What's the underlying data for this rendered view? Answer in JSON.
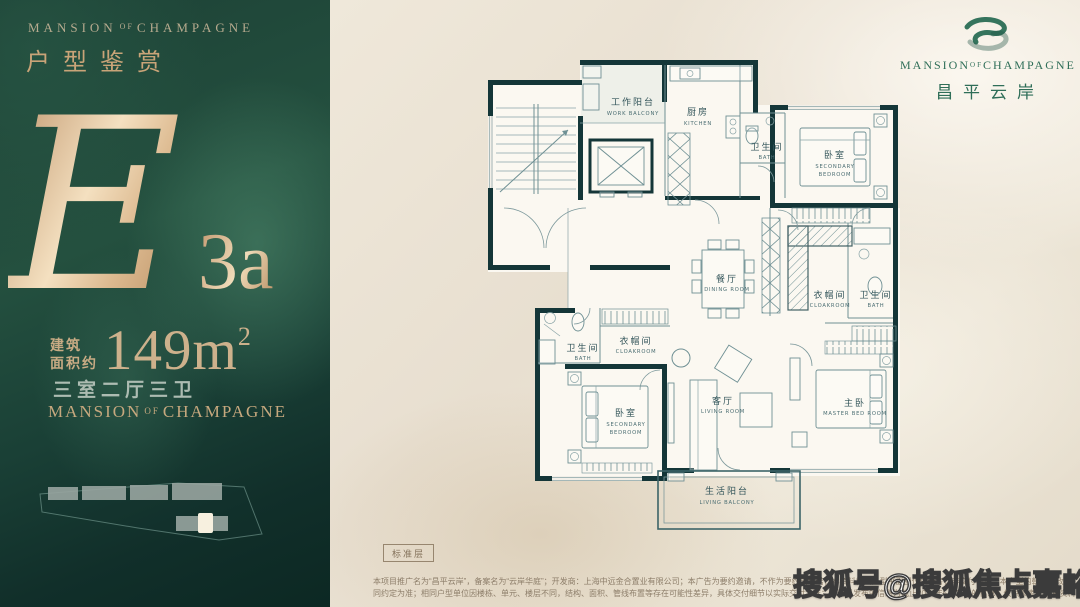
{
  "left_panel": {
    "brand_top": {
      "w1": "MANSION",
      "w2": "OF",
      "w3": "CHAMPAGNE"
    },
    "section_title": "户型鉴赏",
    "unit": {
      "letter": "E",
      "variant": "3a"
    },
    "area": {
      "prefix_line1": "建筑",
      "prefix_line2": "面积约",
      "value": "149m",
      "sup": "2"
    },
    "layout_desc": "三室二厅三卫",
    "brand_bottom": {
      "w1": "MANSION",
      "w2": "OF",
      "w3": "CHAMPAGNE"
    }
  },
  "logo": {
    "brand": {
      "w1": "MANSION",
      "w2": "OF",
      "w3": "CHAMPAGNE"
    },
    "cn": "昌平云岸"
  },
  "floorplan": {
    "floor_tag": "标准层",
    "rooms": {
      "work_balcony": {
        "zh": "工作阳台",
        "en": "WORK BALCONY"
      },
      "kitchen": {
        "zh": "厨房",
        "en": "KITCHEN"
      },
      "bath_top": {
        "zh": "卫生间",
        "en": "BATH"
      },
      "bedroom_top": {
        "zh": "卧室",
        "en1": "SECONDARY",
        "en2": "BEDROOM"
      },
      "dining": {
        "zh": "餐厅",
        "en": "DINING ROOM"
      },
      "cloakroom_right": {
        "zh": "衣帽间",
        "en": "CLOAKROOM"
      },
      "bath_right": {
        "zh": "卫生间",
        "en": "BATH"
      },
      "bath_left": {
        "zh": "卫生间",
        "en": "BATH"
      },
      "cloakroom_left": {
        "zh": "衣帽间",
        "en": "CLOAKROOM"
      },
      "bedroom_bottom": {
        "zh": "卧室",
        "en1": "SECONDARY",
        "en2": "BEDROOM"
      },
      "living": {
        "zh": "客厅",
        "en": "LIVING ROOM"
      },
      "master": {
        "zh": "主卧",
        "en": "MASTER BED ROOM"
      },
      "living_balcony": {
        "zh": "生活阳台",
        "en": "LIVING BALCONY"
      }
    }
  },
  "footer": {
    "disclaimer_line1": "本项目推广名为“昌平云岸”，备案名为“云岸华庭”；开发商：上海中远金合置业有限公司；本广告为要约邀请，不作为要约或承诺；本资料相关户型平面图仅供参考，非交付标准，本户型的朝向以政府最终审批图纸及双方签订的商品房买卖合",
    "disclaimer_line2": "同约定为准；相同户型单位因楼栋、单元、楼层不同，结构、面积、管线布置等存在可能性差异，具体交付细节以实际交付为准；本资料发布的信息为截止2024年5月11日的信息，仅供参考，海报资料不构成合同内容，敬请留意最新信息。"
  },
  "watermark": "搜狐号@搜狐焦点嘉峪关站",
  "colors": {
    "panel_green": "#1d4236",
    "gold": "#d9b88e",
    "wall_teal": "#143638",
    "logo_green": "#2f6e58",
    "cream": "#e9e1d3"
  }
}
